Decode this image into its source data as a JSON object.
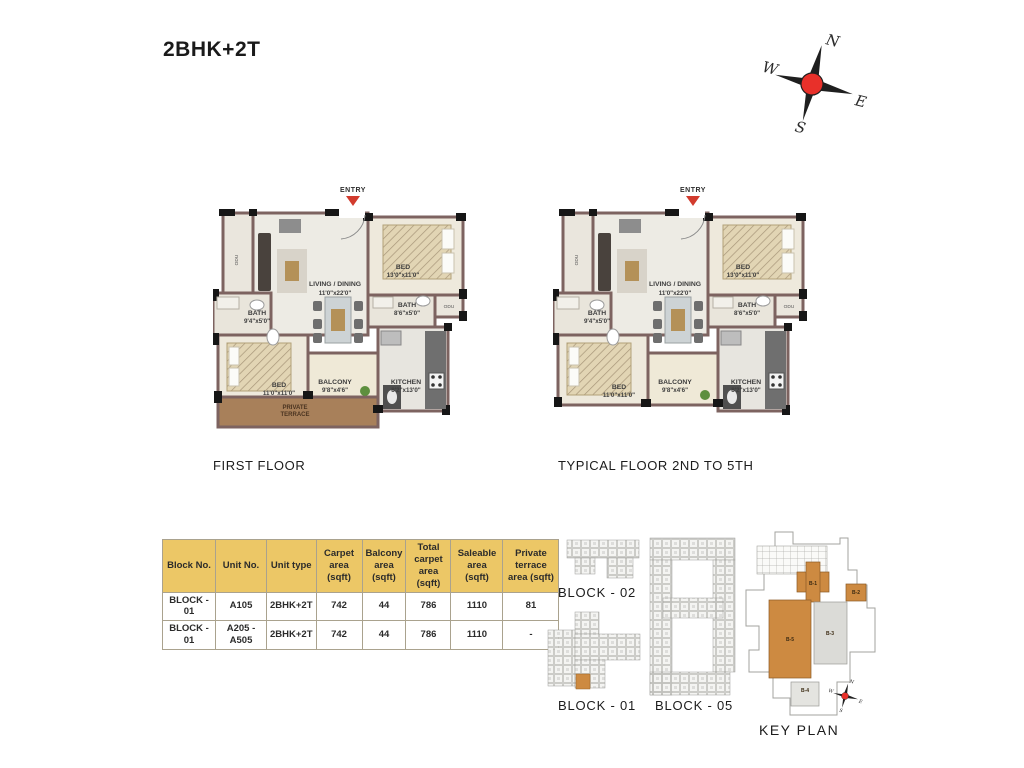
{
  "page": {
    "title": "2BHK+2T"
  },
  "compass": {
    "n": "N",
    "e": "E",
    "s": "S",
    "w": "W"
  },
  "plans": {
    "first": {
      "caption": "FIRST FLOOR",
      "entry": "ENTRY",
      "living_name": "LIVING / DINING",
      "living_dim": "11'0\"x22'0\"",
      "bed1_name": "BED",
      "bed1_dim": "13'0\"x11'0\"",
      "bath1_name": "BATH",
      "bath1_dim": "9'4\"x5'0\"",
      "bath2_name": "BATH",
      "bath2_dim": "8'6\"x5'0\"",
      "bed2_name": "BED",
      "bed2_dim": "11'0\"x11'0\"",
      "balcony_name": "BALCONY",
      "balcony_dim": "9'8\"x4'6\"",
      "kitchen_name": "KITCHEN",
      "kitchen_dim": "8'2\"x13'0\"",
      "terrace_line1": "PRIVATE",
      "terrace_line2": "TERRACE",
      "odu_left": "ODU",
      "odu_right": "ODU"
    },
    "typical": {
      "caption": "TYPICAL FLOOR 2ND TO 5TH",
      "entry": "ENTRY",
      "living_name": "LIVING / DINING",
      "living_dim": "11'0\"x22'0\"",
      "bed1_name": "BED",
      "bed1_dim": "13'0\"x11'0\"",
      "bath1_name": "BATH",
      "bath1_dim": "9'4\"x5'0\"",
      "bath2_name": "BATH",
      "bath2_dim": "8'6\"x5'0\"",
      "bed2_name": "BED",
      "bed2_dim": "11'0\"x11'0\"",
      "balcony_name": "BALCONY",
      "balcony_dim": "9'8\"x4'6\"",
      "kitchen_name": "KITCHEN",
      "kitchen_dim": "8'2\"x13'0\"",
      "odu_left": "ODU",
      "odu_right": "ODU"
    }
  },
  "table": {
    "headers": [
      "Block No.",
      "Unit No.",
      "Unit type",
      "Carpet area (sqft)",
      "Balcony area (sqft)",
      "Total carpet area (sqft)",
      "Saleable area (sqft)",
      "Private terrace area (sqft)"
    ],
    "rows": [
      [
        "BLOCK - 01",
        "A105",
        "2BHK+2T",
        "742",
        "44",
        "786",
        "1110",
        "81"
      ],
      [
        "BLOCK - 01",
        "A205 - A505",
        "2BHK+2T",
        "742",
        "44",
        "786",
        "1110",
        "-"
      ]
    ],
    "header_bg": "#ecc766"
  },
  "site": {
    "block02_label": "BLOCK - 02",
    "block01_label": "BLOCK - 01",
    "block05_label": "BLOCK - 05",
    "keyplan_label": "KEY PLAN",
    "key_blocks": {
      "b1": "B-1",
      "b2": "B-2",
      "b3": "B-3",
      "b4": "B-4",
      "b5": "B-5"
    },
    "highlight_color": "#cd8a41"
  }
}
